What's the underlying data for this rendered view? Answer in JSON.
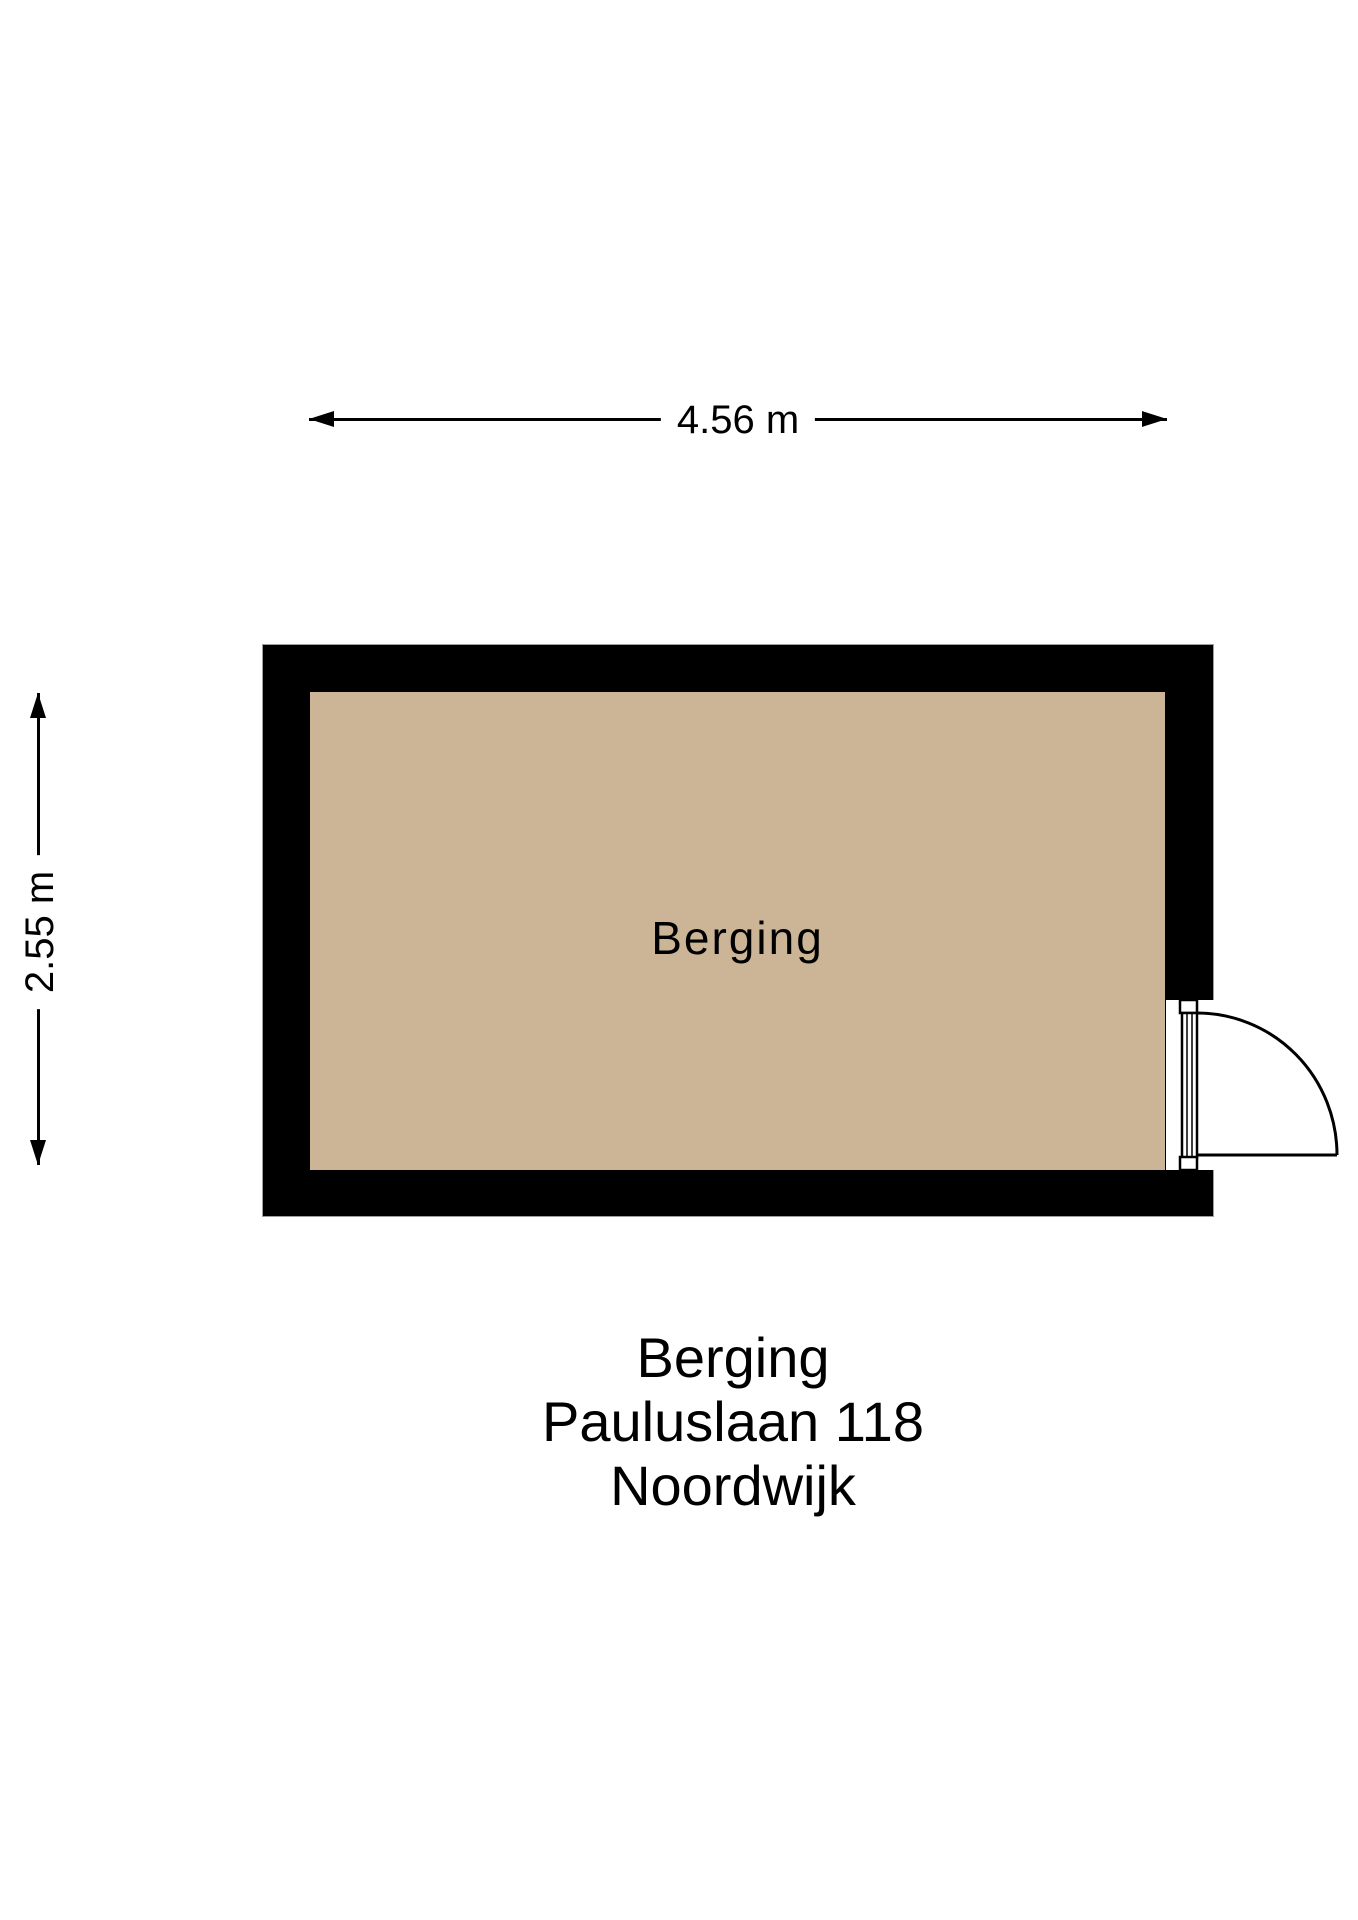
{
  "dimensions": {
    "width": "4.56 m",
    "height": "2.55 m"
  },
  "room": {
    "label": "Berging"
  },
  "title": {
    "lines": [
      "Berging",
      "Pauluslaan 118",
      "Noordwijk"
    ]
  },
  "colors": {
    "floor": "#ccb596",
    "wall": "#000000",
    "line": "#000000",
    "background": "#ffffff"
  }
}
